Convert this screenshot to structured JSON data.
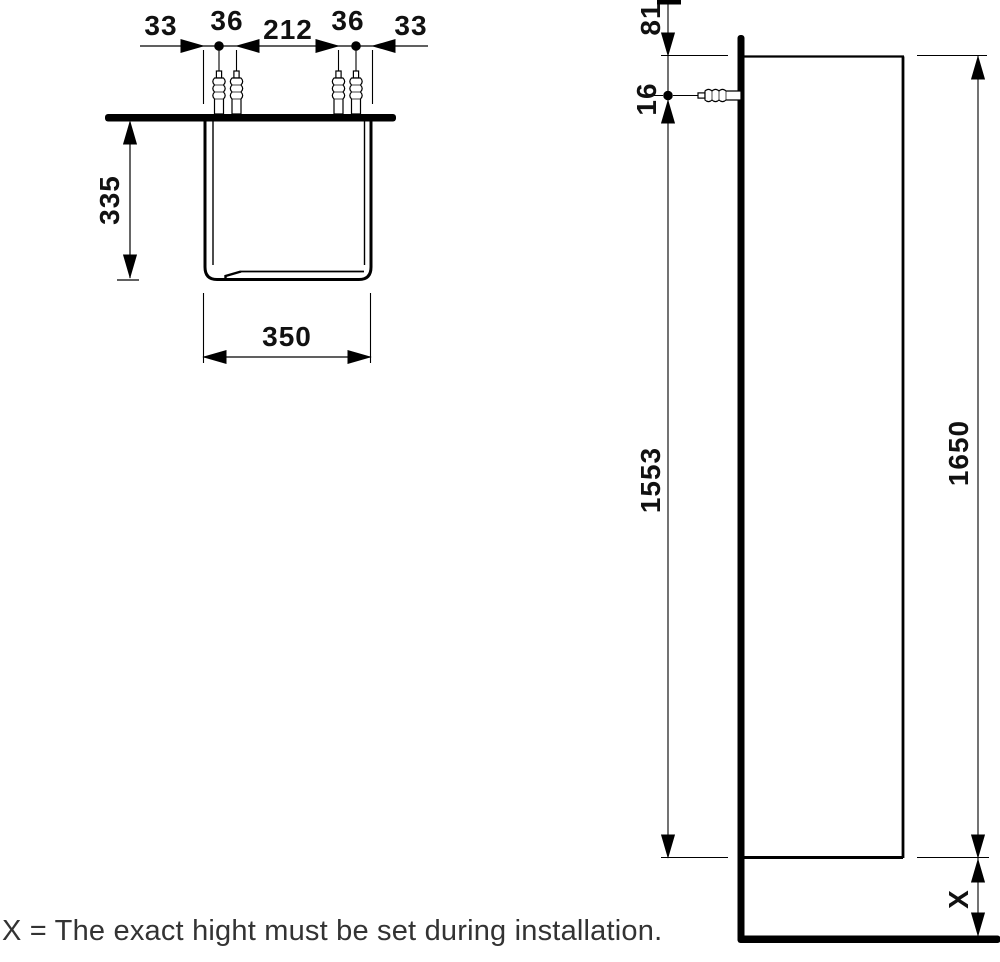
{
  "drawing_title": "tall-cabinet-installation-drawing",
  "note": {
    "text": "X = The exact hight must be set during installation."
  },
  "top_view": {
    "dims": {
      "margin_left": "33",
      "plug_pair_left": "36",
      "plug_span": "212",
      "plug_pair_right": "36",
      "margin_right": "33",
      "depth": "335",
      "width": "350"
    }
  },
  "side_view": {
    "dims": {
      "top_offset": "81",
      "plug_drop": "16",
      "plug_to_bottom": "1553",
      "cabinet_height": "1650",
      "floor_clearance": "X"
    }
  },
  "colors": {
    "line": "#000000",
    "dim_text": "#111111",
    "note_text": "#333333",
    "background": "#ffffff"
  }
}
